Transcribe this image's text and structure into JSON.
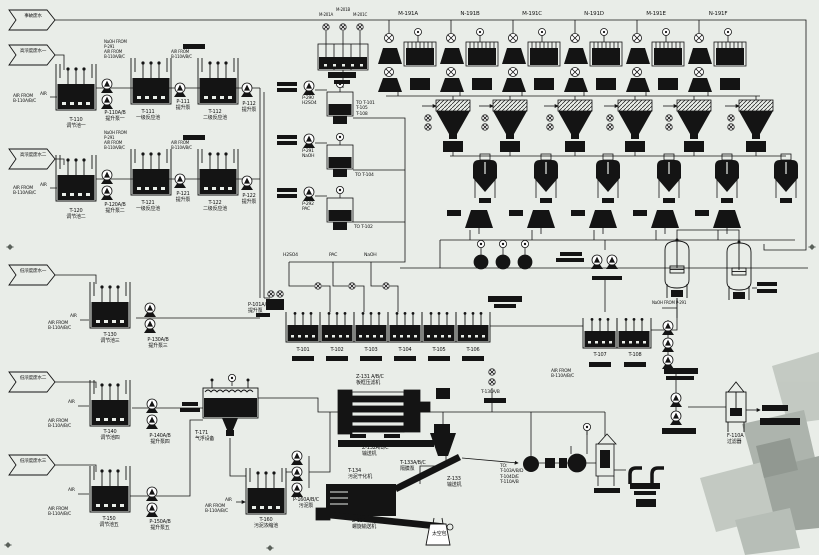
{
  "diagram": {
    "kind": "wastewater-treatment-process-flow-diagram",
    "background": "#e9ede8",
    "ink": "#141414",
    "watermark_grays": [
      "#c2c8c1",
      "#aab1aa",
      "#9aa29b",
      "#8d948d",
      "#b5bcb5"
    ]
  },
  "inlet_flags": [
    {
      "label": "事故废水"
    },
    {
      "label": "高浓度废水一"
    },
    {
      "label": "高浓度废水二"
    },
    {
      "label": "低浓度废水一"
    },
    {
      "label": "低浓度废水二"
    },
    {
      "label": "低浓度废水三"
    }
  ],
  "top_units": [
    "M-191A",
    "N-191B",
    "M-191C",
    "N-191D",
    "M-191E",
    "N-191F"
  ],
  "chemical_station": {
    "mixers": [
      "M-201A",
      "M-201B",
      "M-201C"
    ],
    "dosing": [
      {
        "pump": "P-290",
        "chemical": "H2SO4",
        "to": "TO T-101\nT-105\nT-108"
      },
      {
        "pump": "P-291",
        "chemical": "NaOH",
        "to": "TO T-104"
      },
      {
        "pump": "P-292",
        "chemical": "PAC",
        "to": "TO T-102"
      }
    ]
  },
  "labels": [
    {
      "n": "flag-accident-wastewater",
      "t": "事故废水",
      "x": 33,
      "y": 14,
      "c": 1,
      "s": 4.6
    },
    {
      "n": "flag-high-conc-1",
      "t": "高浓度废水一",
      "x": 33,
      "y": 49,
      "c": 1,
      "s": 4.6
    },
    {
      "n": "flag-high-conc-2",
      "t": "高浓度废水二",
      "x": 33,
      "y": 153,
      "c": 1,
      "s": 4.6
    },
    {
      "n": "flag-low-conc-1",
      "t": "低浓度废水一",
      "x": 33,
      "y": 269,
      "c": 1,
      "s": 4.6
    },
    {
      "n": "flag-low-conc-2",
      "t": "低浓度废水二",
      "x": 33,
      "y": 376,
      "c": 1,
      "s": 4.6
    },
    {
      "n": "flag-low-conc-3",
      "t": "低浓度废水三",
      "x": 33,
      "y": 459,
      "c": 1,
      "s": 4.6
    },
    {
      "n": "unit-m191a-label",
      "t": "M-191A",
      "x": 408,
      "y": 11,
      "c": 1,
      "s": 5.5
    },
    {
      "n": "unit-n191b-label",
      "t": "N-191B",
      "x": 470,
      "y": 11,
      "c": 1,
      "s": 5.5
    },
    {
      "n": "unit-m191c-label",
      "t": "M-191C",
      "x": 532,
      "y": 11,
      "c": 1,
      "s": 5.5
    },
    {
      "n": "unit-n191d-label",
      "t": "N-191D",
      "x": 594,
      "y": 11,
      "c": 1,
      "s": 5.5
    },
    {
      "n": "unit-m191e-label",
      "t": "M-191E",
      "x": 656,
      "y": 11,
      "c": 1,
      "s": 5.5
    },
    {
      "n": "unit-n191f-label",
      "t": "N-191F",
      "x": 718,
      "y": 11,
      "c": 1,
      "s": 5.5
    },
    {
      "n": "mixer-m201a-label",
      "t": "M-201A",
      "x": 326,
      "y": 13,
      "c": 1,
      "s": 4
    },
    {
      "n": "mixer-m201b-label",
      "t": "M-201B",
      "x": 343,
      "y": 8,
      "c": 1,
      "s": 4
    },
    {
      "n": "mixer-m201c-label",
      "t": "M-201C",
      "x": 360,
      "y": 13,
      "c": 1,
      "s": 4
    },
    {
      "n": "tank-t110-label",
      "t": "T-110\n调节池一",
      "x": 76,
      "y": 118,
      "c": 1
    },
    {
      "n": "pump-p110-label",
      "t": "P-110A/B\n提升泵一",
      "x": 115,
      "y": 111,
      "c": 1
    },
    {
      "n": "tank-t111-label",
      "t": "T-111\n一级反应池",
      "x": 148,
      "y": 110,
      "c": 1
    },
    {
      "n": "pump-p111-label",
      "t": "P-111\n提升泵",
      "x": 183,
      "y": 100,
      "c": 1
    },
    {
      "n": "tank-t112-label",
      "t": "T-112\n二级反应池",
      "x": 215,
      "y": 110,
      "c": 1
    },
    {
      "n": "pump-p112-label",
      "t": "P-112\n提升泵",
      "x": 249,
      "y": 102,
      "c": 1
    },
    {
      "n": "tank-t120-label",
      "t": "T-120\n调节池二",
      "x": 76,
      "y": 209,
      "c": 1
    },
    {
      "n": "pump-p120-label",
      "t": "P-120A/B\n提升泵二",
      "x": 115,
      "y": 203,
      "c": 1
    },
    {
      "n": "tank-t121-label",
      "t": "T-121\n一级反应池",
      "x": 148,
      "y": 201,
      "c": 1
    },
    {
      "n": "pump-p121-label",
      "t": "P-121\n提升泵",
      "x": 183,
      "y": 192,
      "c": 1
    },
    {
      "n": "tank-t122-label",
      "t": "T-122\n二级反应池",
      "x": 215,
      "y": 201,
      "c": 1
    },
    {
      "n": "pump-p122-label",
      "t": "P-122\n提升泵",
      "x": 249,
      "y": 194,
      "c": 1
    },
    {
      "n": "tank-t130-label",
      "t": "T-130\n调节池三",
      "x": 110,
      "y": 333,
      "c": 1
    },
    {
      "n": "pump-p130-label",
      "t": "P-130A/B\n提升泵三",
      "x": 158,
      "y": 338,
      "c": 1
    },
    {
      "n": "tank-t140-label",
      "t": "T-140\n调节池四",
      "x": 110,
      "y": 430,
      "c": 1
    },
    {
      "n": "pump-p140-label",
      "t": "P-140A/B\n提升泵四",
      "x": 160,
      "y": 434,
      "c": 1
    },
    {
      "n": "tank-t150-label",
      "t": "T-150\n调节池五",
      "x": 109,
      "y": 517,
      "c": 1
    },
    {
      "n": "pump-p150-label",
      "t": "P-150A/B\n提升泵五",
      "x": 160,
      "y": 520,
      "c": 1
    },
    {
      "n": "daf-t171-label",
      "t": "T-171\n气浮设备",
      "x": 195,
      "y": 431
    },
    {
      "n": "tank-t160-label",
      "t": "T-160\n污泥浓缩池",
      "x": 266,
      "y": 518,
      "c": 1
    },
    {
      "n": "pump-p160-label",
      "t": "P-160A/B/C\n污泥泵",
      "x": 306,
      "y": 498,
      "c": 1
    },
    {
      "n": "pump-p101-label",
      "t": "P-101A/B\n提升泵",
      "x": 248,
      "y": 303
    },
    {
      "n": "tank-t101-label",
      "t": "T-101",
      "x": 303,
      "y": 348,
      "c": 1
    },
    {
      "n": "tank-t102-label",
      "t": "T-102",
      "x": 337,
      "y": 348,
      "c": 1
    },
    {
      "n": "tank-t103-label",
      "t": "T-103",
      "x": 371,
      "y": 348,
      "c": 1
    },
    {
      "n": "tank-t104-label",
      "t": "T-104",
      "x": 405,
      "y": 348,
      "c": 1
    },
    {
      "n": "tank-t105-label",
      "t": "T-105",
      "x": 439,
      "y": 348,
      "c": 1
    },
    {
      "n": "tank-t106-label",
      "t": "T-106",
      "x": 473,
      "y": 348,
      "c": 1
    },
    {
      "n": "tank-t107-label",
      "t": "T-107",
      "x": 600,
      "y": 353,
      "c": 1
    },
    {
      "n": "tank-t108-label",
      "t": "T-108",
      "x": 635,
      "y": 353,
      "c": 1
    },
    {
      "n": "chem-header-h2so4",
      "t": "H2SO4",
      "x": 283,
      "y": 253,
      "s": 4.6
    },
    {
      "n": "chem-header-pac",
      "t": "PAC",
      "x": 329,
      "y": 253,
      "s": 4.6
    },
    {
      "n": "chem-header-naoh",
      "t": "NaOH",
      "x": 364,
      "y": 253,
      "s": 4.6
    },
    {
      "n": "pump-p290-label",
      "t": "P-290\nH2SO4",
      "x": 302,
      "y": 96,
      "s": 4.5
    },
    {
      "n": "dest-t101-label",
      "t": "TO T-101\nT-105\nT-108",
      "x": 356,
      "y": 101,
      "s": 4.5
    },
    {
      "n": "pump-p291-label",
      "t": "P-291\nNaOH",
      "x": 302,
      "y": 149,
      "s": 4.5
    },
    {
      "n": "dest-t104-label",
      "t": "TO T-104",
      "x": 355,
      "y": 173,
      "s": 4.5
    },
    {
      "n": "pump-p292-label",
      "t": "P-292\nPAC",
      "x": 302,
      "y": 202,
      "s": 4.5
    },
    {
      "n": "dest-t102-label",
      "t": "TO T-102",
      "x": 354,
      "y": 225,
      "s": 4.5
    },
    {
      "n": "air-from-note",
      "t": "AIR FROM\nB-110A/B/C",
      "x": 13,
      "y": 94,
      "s": 4.4
    },
    {
      "n": "air-from-note",
      "t": "AIR FROM\nB-110A/B/C",
      "x": 104,
      "y": 50,
      "s": 4
    },
    {
      "n": "air-from-note",
      "t": "AIR FROM\nB-110A/B/C",
      "x": 171,
      "y": 50,
      "s": 4
    },
    {
      "n": "air-from-note",
      "t": "AIR FROM\nB-110A/B/C",
      "x": 13,
      "y": 186,
      "s": 4.4
    },
    {
      "n": "air-from-note",
      "t": "AIR FROM\nB-110A/B/C",
      "x": 104,
      "y": 141,
      "s": 4
    },
    {
      "n": "air-from-note",
      "t": "AIR FROM\nB-110A/B/C",
      "x": 171,
      "y": 141,
      "s": 4
    },
    {
      "n": "air-from-note",
      "t": "AIR FROM\nB-110A/B/C",
      "x": 48,
      "y": 321,
      "s": 4.4
    },
    {
      "n": "air-from-note",
      "t": "AIR FROM\nB-110A/B/C",
      "x": 48,
      "y": 419,
      "s": 4.4
    },
    {
      "n": "air-from-note",
      "t": "AIR FROM\nB-110A/B/C",
      "x": 48,
      "y": 507,
      "s": 4.4
    },
    {
      "n": "air-from-note",
      "t": "AIR FROM\nB-110A/B/C",
      "x": 205,
      "y": 504,
      "s": 4.4
    },
    {
      "n": "air-from-note",
      "t": "AIR FROM\nB-110A/B/C",
      "x": 551,
      "y": 369,
      "s": 4.4
    },
    {
      "n": "naoh-from-note",
      "t": "NaOH FROM\nP-291",
      "x": 104,
      "y": 40,
      "s": 4
    },
    {
      "n": "naoh-from-note",
      "t": "NaOH FROM\nP-291",
      "x": 104,
      "y": 131,
      "s": 4
    },
    {
      "n": "naoh-from-note",
      "t": "NaOH FROM P-291",
      "x": 652,
      "y": 301,
      "s": 4
    },
    {
      "n": "air-tag",
      "t": "AIR",
      "x": 40,
      "y": 92,
      "s": 4.4
    },
    {
      "n": "air-tag",
      "t": "AIR",
      "x": 40,
      "y": 183,
      "s": 4.4
    },
    {
      "n": "air-tag",
      "t": "AIR",
      "x": 70,
      "y": 314,
      "s": 4.4
    },
    {
      "n": "air-tag",
      "t": "AIR",
      "x": 68,
      "y": 400,
      "s": 4.4
    },
    {
      "n": "air-tag",
      "t": "AIR",
      "x": 68,
      "y": 488,
      "s": 4.4
    },
    {
      "n": "air-tag",
      "t": "AIR",
      "x": 225,
      "y": 498,
      "s": 4.4
    },
    {
      "n": "press-z131-label",
      "t": "Z-131 A/B/C\n板框压滤机",
      "x": 356,
      "y": 375
    },
    {
      "n": "conveyor-z132-label",
      "t": "Z-132A/B/C\n输送机",
      "x": 362,
      "y": 446
    },
    {
      "n": "dryer-t134-label",
      "t": "T-134\n污泥干化机",
      "x": 348,
      "y": 469
    },
    {
      "n": "pump-t133-label",
      "t": "T-133A/B/C\n隔膜泵",
      "x": 400,
      "y": 461
    },
    {
      "n": "conveyor-z133-label",
      "t": "Z-133\n输送机",
      "x": 447,
      "y": 477
    },
    {
      "n": "conveyor-z134-label",
      "t": "Z-134\n螺旋输送机",
      "x": 352,
      "y": 519
    },
    {
      "n": "bulk-bag-label",
      "t": "太空包",
      "x": 432,
      "y": 532
    },
    {
      "n": "recycle-dest-label",
      "t": "TO:\nT-103A/B/D\nT-104D/E\nT-110A/B",
      "x": 500,
      "y": 464,
      "s": 4.5
    },
    {
      "n": "pump-t130ab-label",
      "t": "T-130A/B",
      "x": 481,
      "y": 390,
      "s": 4.5
    },
    {
      "n": "filter-f110a-label",
      "t": "F-110A\n过滤器",
      "x": 727,
      "y": 434
    }
  ]
}
